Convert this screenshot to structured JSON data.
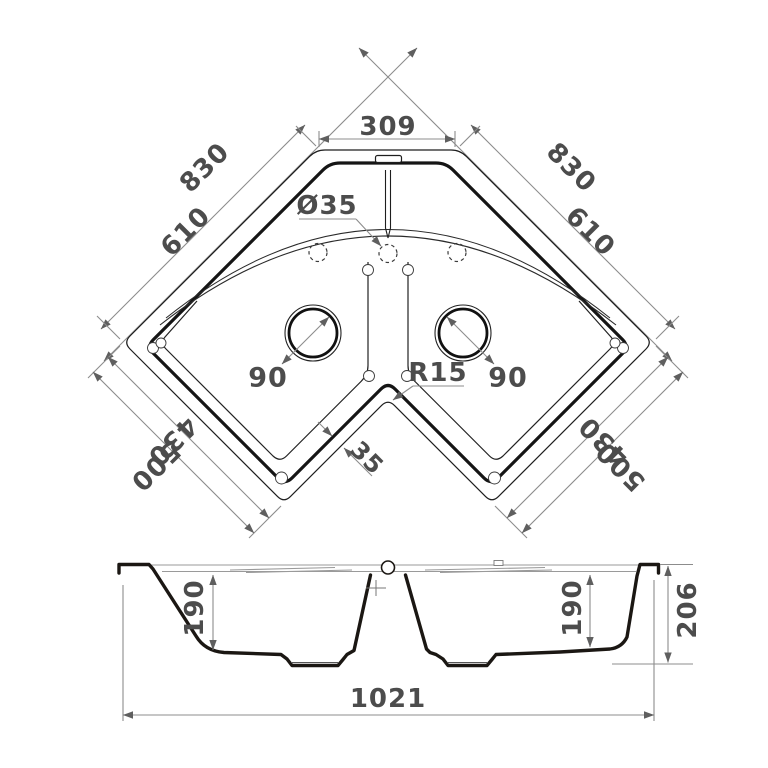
{
  "top_view": {
    "dim_top_width": "309",
    "dim_side_outer_left": "830",
    "dim_side_outer_right": "830",
    "dim_side_inner_left": "610",
    "dim_side_inner_right": "610",
    "faucet_hole_diameter": "Ø35",
    "drain_diameter_left": "90",
    "drain_diameter_right": "90",
    "corner_radius": "R15",
    "rim_width": "35",
    "dim_bottom_inner_left": "430",
    "dim_bottom_outer_left": "500",
    "dim_bottom_inner_right": "430",
    "dim_bottom_outer_right": "500"
  },
  "section_view": {
    "bowl_depth_left": "190",
    "bowl_depth_right": "190",
    "overall_height": "206",
    "overall_width": "1021"
  }
}
